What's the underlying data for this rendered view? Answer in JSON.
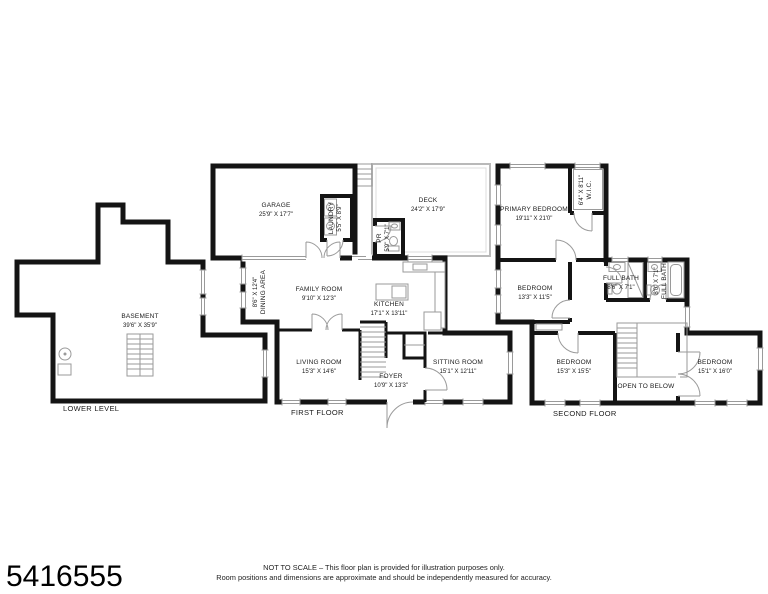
{
  "page": {
    "listing_id": "5416555",
    "disclaimer_line1": "NOT TO SCALE – This floor plan is provided for illustration purposes only.",
    "disclaimer_line2": "Room positions and dimensions are approximate and should be independently measured for accuracy."
  },
  "floors": {
    "lower": {
      "name": "LOWER LEVEL",
      "rooms": {
        "basement": {
          "label": "BASEMENT",
          "dims": "39'6\" X 35'9\""
        }
      }
    },
    "first": {
      "name": "FIRST FLOOR",
      "rooms": {
        "garage": {
          "label": "GARAGE",
          "dims": "25'9\" X 17'7\""
        },
        "deck": {
          "label": "DECK",
          "dims": "24'2\" X 17'9\""
        },
        "laundry": {
          "label": "LAUNDRY",
          "dims": "5'5\" X 8'9\""
        },
        "powder": {
          "label": "PR",
          "dims": "5'9\" X 7'1\""
        },
        "dining": {
          "label": "DINING AREA",
          "dims": "8'6\" X 12'4\""
        },
        "family": {
          "label": "FAMILY ROOM",
          "dims": "9'10\" X 12'3\""
        },
        "kitchen": {
          "label": "KITCHEN",
          "dims": "17'1\" X 13'11\""
        },
        "living": {
          "label": "LIVING ROOM",
          "dims": "15'3\" X 14'6\""
        },
        "foyer": {
          "label": "FOYER",
          "dims": "10'9\" X 13'3\""
        },
        "sitting": {
          "label": "SITTING ROOM",
          "dims": "15'1\" X 12'11\""
        }
      }
    },
    "second": {
      "name": "SECOND FLOOR",
      "rooms": {
        "primary": {
          "label": "PRIMARY BEDROOM",
          "dims": "19'11\" X 21'0\""
        },
        "wic": {
          "label": "W.I.C.",
          "dims": "6'4\" X 8'11\""
        },
        "bedroom2": {
          "label": "BEDROOM",
          "dims": "13'3\" X 11'5\""
        },
        "bath1": {
          "label": "FULL BATH",
          "dims": "8'6\" X 7'1\""
        },
        "bath2": {
          "label": "FULL BATH",
          "dims": "8'0\" X 7'1\""
        },
        "bedroom3": {
          "label": "BEDROOM",
          "dims": "15'3\" X 15'5\""
        },
        "open_below": {
          "label": "OPEN TO BELOW"
        },
        "bedroom4": {
          "label": "BEDROOM",
          "dims": "15'1\" X 16'0\""
        }
      }
    }
  }
}
